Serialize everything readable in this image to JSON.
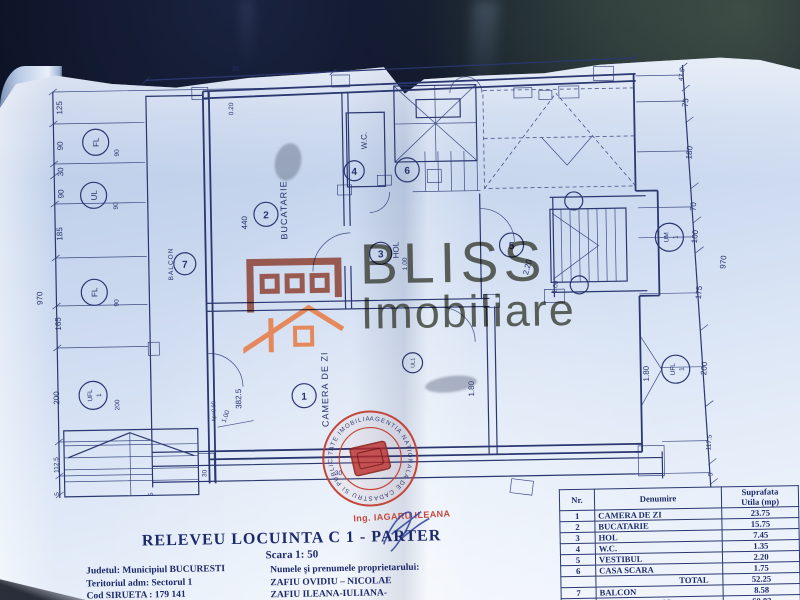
{
  "photo": {
    "background": "#0a0f1e",
    "paper": "#cddcf1",
    "ink": "#2b3770",
    "stamp_red": "#c0392b",
    "brand_brick": "#8a3c2c",
    "brand_orange": "#e8743a",
    "brand_gray": "#3c4036"
  },
  "watermark": {
    "brand_top": "BLISS",
    "brand_bottom": "Imobiliare"
  },
  "engineer": {
    "label": "Ing. IAGARU ILEANA"
  },
  "stamp": {
    "ring_text": "AGENTIA NATIONALA DE CADASTRU SI PUBLICITATE IMOBILIARA •"
  },
  "plan": {
    "total_left": "970",
    "total_right": "970",
    "left": [
      "125",
      "90",
      "30",
      "90",
      "185",
      "165",
      "200",
      "112.5",
      "5"
    ],
    "left_win": [
      "90",
      "90",
      "90",
      "200"
    ],
    "right": [
      "47.5",
      "75",
      "180",
      "70",
      "100",
      "175",
      "200",
      "117.5",
      "5"
    ],
    "markers": {
      "fl": "FL",
      "ul": "UL",
      "ufl": "UFL",
      "um": "UM",
      "one": "1",
      "ul1": "UL1"
    },
    "rooms": {
      "living": {
        "nr": "1",
        "name": "CAMERA DE ZI"
      },
      "kitchen": {
        "nr": "2",
        "name": "BUCATARIE"
      },
      "hol": {
        "nr": "3",
        "name": "HOL"
      },
      "wc": {
        "nr": "4",
        "name": "W.C."
      },
      "vestibul": {
        "nr": "5"
      },
      "stairwell": {
        "nr": "6"
      },
      "balcony": {
        "nr": "7",
        "name": "BALCON"
      }
    },
    "inner": {
      "kitchen_h": "440",
      "living_w": "382.5",
      "hp": "hp=0.90",
      "door_w": "1.00",
      "vest_w": "2.20",
      "vest_d": "1.00",
      "hol_d": "1.80",
      "hol_w": "1.00",
      "w30a": "30",
      "w30b": "30",
      "w5": "5",
      "top020": "0.20",
      "top30": "30"
    }
  },
  "title_block": {
    "title": "RELEVEU  LOCUINTA C 1 - PARTER",
    "scale": "Scara 1: 50",
    "admin": [
      "Judetul: Municipiul  BUCURESTI",
      "Teritoriul  adm:  Sectorul 1",
      "Cod SIRUETA : 179 141"
    ],
    "owner_label": "Numele şi  prenumele proprietarului:",
    "owners": [
      "ZAFIU    OVIDIU – NICOLAE",
      "ZAFIU    ILEANA-IULIANA-"
    ]
  },
  "area_table": {
    "header": {
      "nr": "Nr.",
      "name": "Denumire",
      "area_line1": "Suprafata",
      "area_line2": "Utila (mp)"
    },
    "rows": [
      {
        "nr": "1",
        "name": "CAMERA DE ZI",
        "area": "23.75"
      },
      {
        "nr": "2",
        "name": "BUCATARIE",
        "area": "15.75"
      },
      {
        "nr": "3",
        "name": "HOL",
        "area": "7.45"
      },
      {
        "nr": "4",
        "name": "W.C.",
        "area": "1.35"
      },
      {
        "nr": "5",
        "name": "VESTIBUL",
        "area": "2.20"
      },
      {
        "nr": "6",
        "name": "CASA SCARA",
        "area": "1.75"
      },
      {
        "nr": "",
        "name": "TOTAL",
        "area": "52.25"
      },
      {
        "nr": "7",
        "name": "BALCON",
        "area": "8.58"
      },
      {
        "nr": "",
        "name": "TOTAL GENERAL",
        "area": "60.83"
      }
    ]
  }
}
